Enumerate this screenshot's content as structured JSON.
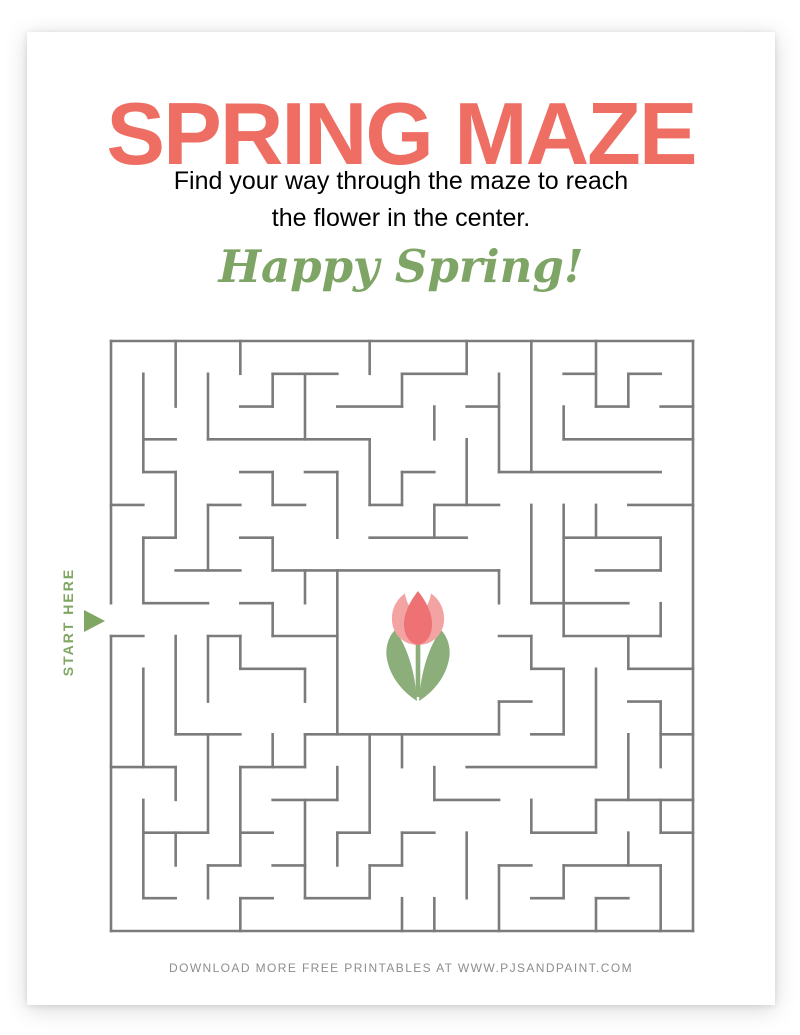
{
  "page": {
    "title": "SPRING MAZE",
    "subtitle_line1": "Find your way through the maze to reach",
    "subtitle_line2": "the flower in the center.",
    "greeting": "Happy Spring!",
    "start_label": "START HERE",
    "footer": "DOWNLOAD MORE FREE PRINTABLES AT WWW.PJSANDPAINT.COM"
  },
  "colors": {
    "title": "#EE6E63",
    "subtitle": "#4F4F4F",
    "greeting": "#7EA565",
    "start": "#7FA763",
    "maze_wall": "#7B7B7B",
    "footer": "#8D8D8D",
    "tulip_petal_outer": "#F2A3A2",
    "tulip_petal_inner": "#EE7173",
    "tulip_leaf": "#8CAE7A"
  },
  "maze": {
    "cols": 18,
    "rows": 18,
    "wall_thickness": 2.6,
    "start_opening": {
      "side": "left",
      "row": 8
    },
    "center_open_area": {
      "col_start": 7,
      "col_end": 12,
      "row_start": 7,
      "row_end": 12
    },
    "h_walls": [
      [
        0,
        0,
        18
      ],
      [
        1,
        5,
        7
      ],
      [
        1,
        9,
        11
      ],
      [
        1,
        14,
        15
      ],
      [
        1,
        16,
        17
      ],
      [
        2,
        4,
        5
      ],
      [
        2,
        7,
        9
      ],
      [
        2,
        11,
        12
      ],
      [
        2,
        15,
        16
      ],
      [
        2,
        17,
        18
      ],
      [
        3,
        1,
        2
      ],
      [
        3,
        3,
        8
      ],
      [
        3,
        14,
        18
      ],
      [
        4,
        1,
        2
      ],
      [
        4,
        4,
        5
      ],
      [
        4,
        6,
        7
      ],
      [
        4,
        9,
        10
      ],
      [
        4,
        12,
        17
      ],
      [
        5,
        0,
        1
      ],
      [
        5,
        3,
        4
      ],
      [
        5,
        5,
        6
      ],
      [
        5,
        8,
        9
      ],
      [
        5,
        10,
        12
      ],
      [
        5,
        16,
        18
      ],
      [
        6,
        1,
        2
      ],
      [
        6,
        4,
        5
      ],
      [
        6,
        8,
        11
      ],
      [
        6,
        14,
        17
      ],
      [
        7,
        2,
        4
      ],
      [
        7,
        5,
        12
      ],
      [
        7,
        15,
        17
      ],
      [
        8,
        1,
        3
      ],
      [
        8,
        4,
        5
      ],
      [
        8,
        13,
        16
      ],
      [
        9,
        0,
        1
      ],
      [
        9,
        3,
        4
      ],
      [
        9,
        5,
        7
      ],
      [
        9,
        12,
        13
      ],
      [
        9,
        14,
        17
      ],
      [
        10,
        4,
        6
      ],
      [
        10,
        13,
        14
      ],
      [
        10,
        16,
        18
      ],
      [
        11,
        12,
        13
      ],
      [
        11,
        16,
        17
      ],
      [
        12,
        2,
        4
      ],
      [
        12,
        6,
        12
      ],
      [
        12,
        13,
        14
      ],
      [
        12,
        17,
        18
      ],
      [
        13,
        0,
        2
      ],
      [
        13,
        4,
        6
      ],
      [
        13,
        11,
        15
      ],
      [
        14,
        5,
        7
      ],
      [
        14,
        10,
        12
      ],
      [
        14,
        15,
        18
      ],
      [
        15,
        1,
        3
      ],
      [
        15,
        4,
        5
      ],
      [
        15,
        7,
        8
      ],
      [
        15,
        9,
        10
      ],
      [
        15,
        13,
        15
      ],
      [
        15,
        17,
        18
      ],
      [
        16,
        3,
        4
      ],
      [
        16,
        5,
        6
      ],
      [
        16,
        8,
        9
      ],
      [
        16,
        12,
        13
      ],
      [
        16,
        14,
        17
      ],
      [
        17,
        1,
        2
      ],
      [
        17,
        4,
        5
      ],
      [
        17,
        6,
        8
      ],
      [
        17,
        13,
        14
      ],
      [
        17,
        15,
        16
      ],
      [
        18,
        0,
        18
      ]
    ],
    "v_walls": [
      [
        0,
        0,
        8
      ],
      [
        0,
        9,
        18
      ],
      [
        1,
        1,
        4
      ],
      [
        1,
        6,
        8
      ],
      [
        1,
        10,
        13
      ],
      [
        1,
        14,
        17
      ],
      [
        2,
        0,
        2
      ],
      [
        2,
        4,
        6
      ],
      [
        2,
        9,
        12
      ],
      [
        2,
        13,
        14
      ],
      [
        2,
        15,
        16
      ],
      [
        3,
        1,
        3
      ],
      [
        3,
        5,
        7
      ],
      [
        3,
        9,
        11
      ],
      [
        3,
        12,
        15
      ],
      [
        3,
        16,
        17
      ],
      [
        4,
        0,
        1
      ],
      [
        4,
        9,
        10
      ],
      [
        4,
        13,
        16
      ],
      [
        4,
        17,
        18
      ],
      [
        5,
        1,
        2
      ],
      [
        5,
        4,
        5
      ],
      [
        5,
        6,
        7
      ],
      [
        5,
        8,
        9
      ],
      [
        5,
        12,
        13
      ],
      [
        6,
        1,
        3
      ],
      [
        6,
        7,
        8
      ],
      [
        6,
        10,
        11
      ],
      [
        6,
        12,
        13
      ],
      [
        6,
        14,
        17
      ],
      [
        7,
        4,
        6
      ],
      [
        7,
        7,
        12
      ],
      [
        7,
        13,
        14
      ],
      [
        7,
        15,
        16
      ],
      [
        8,
        0,
        1
      ],
      [
        8,
        3,
        5
      ],
      [
        8,
        12,
        15
      ],
      [
        8,
        16,
        17
      ],
      [
        9,
        1,
        2
      ],
      [
        9,
        4,
        5
      ],
      [
        9,
        12,
        13
      ],
      [
        9,
        15,
        16
      ],
      [
        9,
        17,
        18
      ],
      [
        10,
        2,
        3
      ],
      [
        10,
        5,
        6
      ],
      [
        10,
        13,
        14
      ],
      [
        10,
        17,
        18
      ],
      [
        11,
        0,
        1
      ],
      [
        11,
        3,
        5
      ],
      [
        11,
        15,
        17
      ],
      [
        12,
        1,
        4
      ],
      [
        12,
        7,
        8
      ],
      [
        12,
        11,
        12
      ],
      [
        12,
        16,
        18
      ],
      [
        13,
        0,
        4
      ],
      [
        13,
        5,
        8
      ],
      [
        13,
        9,
        10
      ],
      [
        13,
        14,
        15
      ],
      [
        14,
        2,
        3
      ],
      [
        14,
        5,
        9
      ],
      [
        14,
        10,
        12
      ],
      [
        14,
        16,
        17
      ],
      [
        15,
        0,
        2
      ],
      [
        15,
        5,
        6
      ],
      [
        15,
        10,
        13
      ],
      [
        15,
        14,
        15
      ],
      [
        15,
        17,
        18
      ],
      [
        16,
        1,
        2
      ],
      [
        16,
        9,
        10
      ],
      [
        16,
        12,
        14
      ],
      [
        16,
        15,
        16
      ],
      [
        17,
        6,
        7
      ],
      [
        17,
        8,
        9
      ],
      [
        17,
        11,
        13
      ],
      [
        17,
        14,
        15
      ],
      [
        17,
        16,
        18
      ],
      [
        18,
        0,
        18
      ]
    ]
  }
}
